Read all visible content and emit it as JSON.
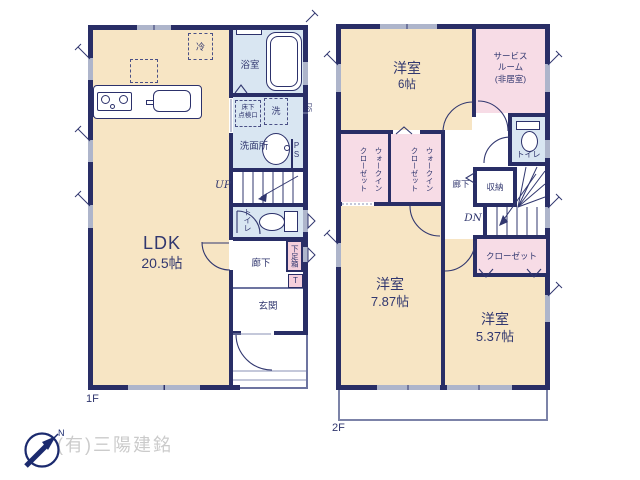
{
  "floor1": {
    "label": "1F",
    "ldk": {
      "name": "LDK",
      "size": "20.5帖"
    },
    "bathroom": "浴室",
    "washroom": "洗面所",
    "floor_hatch": "床下\n点検口",
    "washer": "洗",
    "fridge": "冷",
    "pipe_space": "PS",
    "duct_space": "DS",
    "stairs_up": "UP",
    "toilet": "トイレ",
    "hallway": "廊下",
    "shoe_box": "下足箱",
    "shoe_box_t": "T",
    "entrance": "玄関"
  },
  "floor2": {
    "label": "2F",
    "bedroom_6": {
      "name": "洋室",
      "size": "6帖"
    },
    "service_room": "サービス\nルーム\n(非居室)",
    "wic": "ウォークイン\nクローゼット",
    "hallway": "廊下",
    "storage": "収納",
    "toilet": "トイレ",
    "stairs_down": "DN",
    "closet": "クローゼット",
    "bedroom_787": {
      "name": "洋室",
      "size": "7.87帖"
    },
    "bedroom_537": {
      "name": "洋室",
      "size": "5.37帖"
    }
  },
  "footer": {
    "company": "(有)三陽建銘",
    "north_label": "N"
  },
  "colors": {
    "wall": "#292e66",
    "room_cream": "#f7e5c4",
    "room_pink": "#f7dce6",
    "room_blue": "#d9e6f2",
    "shoe_box_pink": "#f4cfdb",
    "window_gray": "#aeb5cb",
    "company_gray": "#cbcbcb"
  }
}
